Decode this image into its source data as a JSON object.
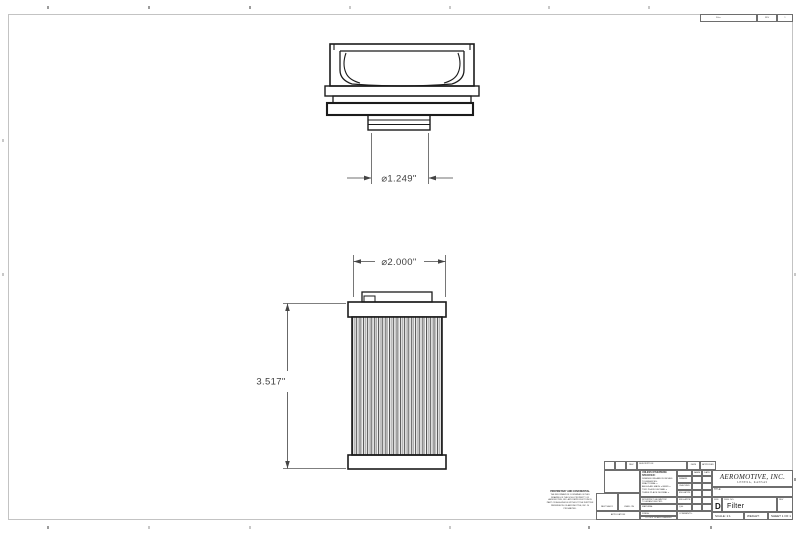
{
  "dimensions": {
    "port_diameter": "⌀1.249\"",
    "element_diameter": "⌀2.000\"",
    "element_height": "3.517\""
  },
  "title_block": {
    "company": "AEROMOTIVE, INC.",
    "company_sub": "LENEXA, KANSAS",
    "unless": "UNLESS OTHERWISE SPECIFIED:",
    "tol_lines": [
      "DIMENSIONS ARE IN INCHES",
      "TOLERANCES:",
      "FRACTIONAL ±",
      "ANGULAR: MACH ±  BEND ±",
      "TWO PLACE DECIMAL    ±",
      "THREE PLACE DECIMAL  ±"
    ],
    "interpret": "INTERPRET GEOMETRIC TOLERANCING PER:",
    "material_label": "MATERIAL",
    "finish_label": "FINISH",
    "do_not_scale": "DO NOT SCALE DRAWING",
    "name_label": "NAME",
    "date_label": "DATE",
    "rows": [
      "DRAWN",
      "CHECKED",
      "ENG APPR.",
      "MFG APPR.",
      "Q.A.",
      "COMMENTS:"
    ],
    "title_label": "TITLE:",
    "size_label": "SIZE",
    "size": "D",
    "dwg_label": "DWG.  NO.",
    "dwg_no": "Filter",
    "rev_label": "REV",
    "scale": "SCALE: 1:1",
    "weight_label": "WEIGHT:",
    "sheet": "SHEET 1 OF 1",
    "proprietary_title": "PROPRIETARY AND CONFIDENTIAL",
    "proprietary_text": "THE INFORMATION CONTAINED IN THIS DRAWING IS THE SOLE PROPERTY OF AEROMOTIVE, INC.  ANY REPRODUCTION IN PART OR AS A WHOLE WITHOUT THE WRITTEN PERMISSION OF AEROMOTIVE, INC. IS PROHIBITED.",
    "next_assy": "NEXT ASSY",
    "used_on": "USED ON",
    "application": "APPLICATION",
    "rev_strip": {
      "rev": "REV.",
      "description": "DESCRIPTION",
      "date": "DATE",
      "approved": "APPROVED"
    },
    "top_strip": {
      "dwg_no": "Filter",
      "rev": "REV",
      "sheet": "1"
    }
  }
}
